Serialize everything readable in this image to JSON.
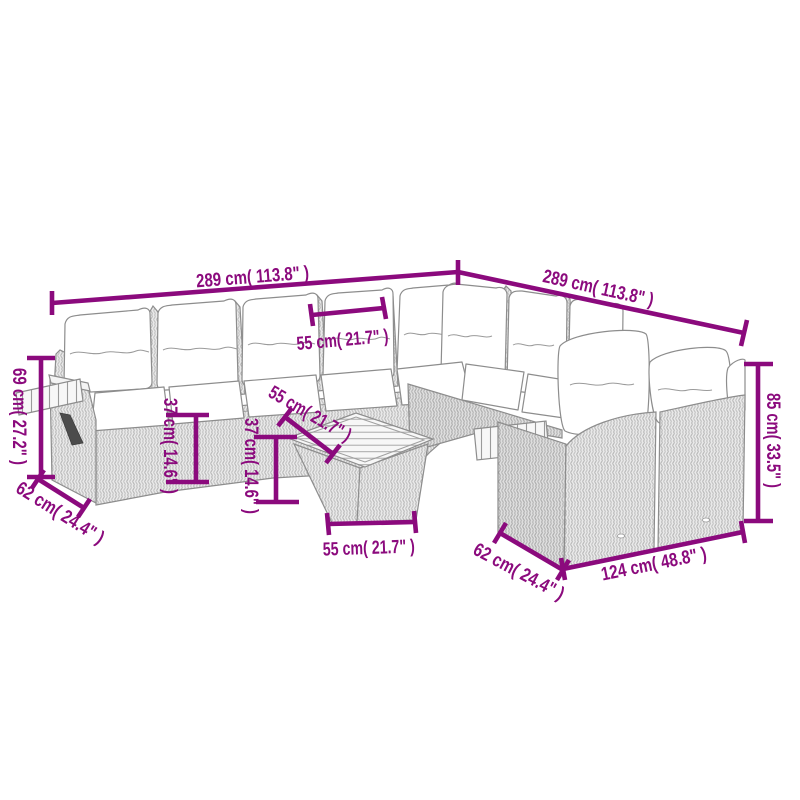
{
  "diagram": {
    "background": "#ffffff",
    "annotation_color": "#8B0A7D",
    "illustration_subject": "l-shaped-rattan-garden-lounge-set-with-ottoman-table",
    "dimensions": {
      "overall_width_left": "289 cm( 113.8\" )",
      "overall_width_right": "289 cm( 113.8\" )",
      "seat_module_width": "55 cm( 21.7\" )",
      "armrest_height": "69 cm( 27.2\" )",
      "left_section_depth": "62 cm( 24.4\" )",
      "seat_height": "37 cm( 14.6\" )",
      "table_height": "37 cm( 14.6\" )",
      "table_depth": "55 cm( 21.7\" )",
      "table_width": "55 cm( 21.7\" )",
      "backrest_height": "85 cm( 33.5\" )",
      "right_section_depth": "62 cm( 24.4\" )",
      "right_section_width": "124 cm( 48.8\" )"
    }
  }
}
